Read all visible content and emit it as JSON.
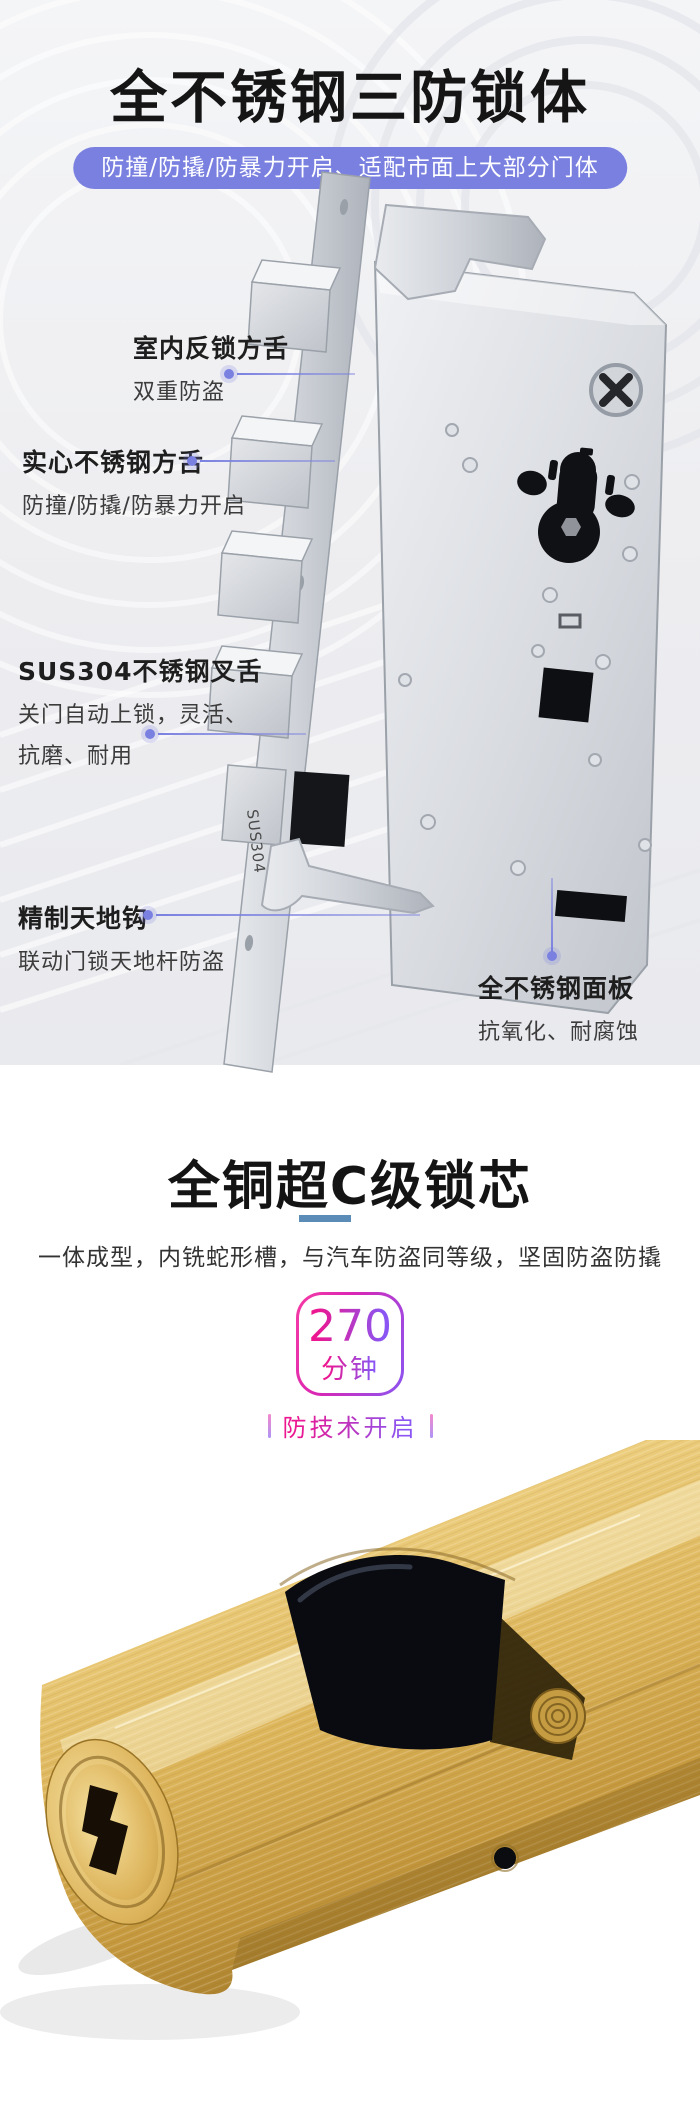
{
  "s1": {
    "title": "全不锈钢三防锁体",
    "banner": "防撞/防撬/防暴力开启、适配市面上大部分门体",
    "callouts": [
      {
        "title": "室内反锁方舌",
        "desc": "双重防盗"
      },
      {
        "title": "实心不锈钢方舌",
        "desc": "防撞/防撬/防暴力开启"
      },
      {
        "title": "SUS304不锈钢叉舌",
        "desc": "关门自动上锁，灵活、",
        "desc2": "抗磨、耐用"
      },
      {
        "title": "精制天地钩",
        "desc": "联动门锁天地杆防盗"
      },
      {
        "title": "全不锈钢面板",
        "desc": "抗氧化、耐腐蚀"
      }
    ],
    "lock_label": "SUS304",
    "colors": {
      "accent": "#7a80e0",
      "banner_bg": "#7a80e0",
      "title": "#151515"
    }
  },
  "s2": {
    "title": "全铜超C级锁芯",
    "subtitle": "一体成型，内铣蛇形槽，与汽车防盗同等级，坚固防盗防撬",
    "badge_value": "270",
    "badge_unit": "分钟",
    "caption": "防技术开启",
    "colors": {
      "gradient_from": "#ec1690",
      "gradient_to": "#8a55f2",
      "underline": "#5b8cb8",
      "brass": "#ddb55a"
    }
  }
}
